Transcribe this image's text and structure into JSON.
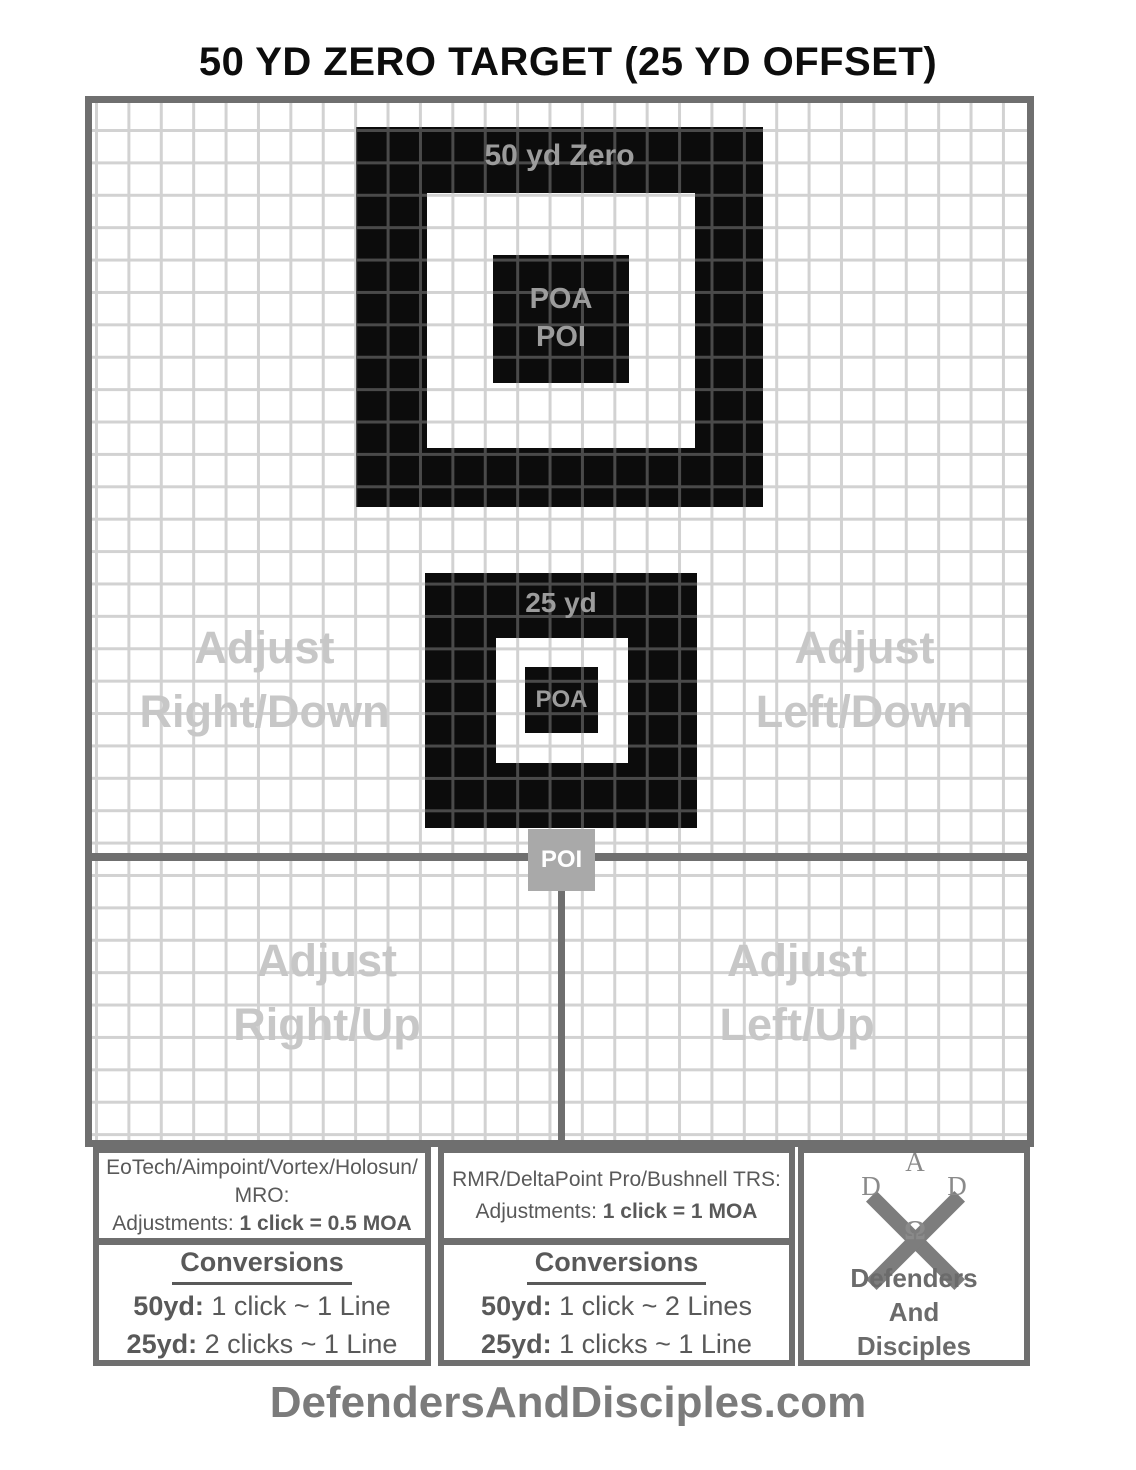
{
  "title": "50 YD ZERO TARGET (25 YD OFFSET)",
  "grid": {
    "target_50": {
      "label": "50 yd Zero",
      "line1": "POA",
      "line2": "POI"
    },
    "target_25": {
      "label": "25 yd",
      "poa": "POA"
    },
    "poi_marker": "POI",
    "watermarks": {
      "upper_left": {
        "line1": "Adjust",
        "line2": "Right/Down"
      },
      "upper_right": {
        "line1": "Adjust",
        "line2": "Left/Down"
      },
      "lower_left": {
        "line1": "Adjust",
        "line2": "Right/Up"
      },
      "lower_right": {
        "line1": "Adjust",
        "line2": "Left/Up"
      }
    }
  },
  "panels": {
    "left": {
      "optics_line1": "EoTech/Aimpoint/Vortex/Holosun/",
      "optics_line2": "MRO:",
      "adjustments_label": "Adjustments: ",
      "adjustments_value": "1 click = 0.5 MOA",
      "conversions_title": "Conversions",
      "conv_rows": [
        {
          "label": "50yd:",
          "value": " 1 click ~ 1 Line"
        },
        {
          "label": "25yd:",
          "value": " 2 clicks ~ 1 Line"
        }
      ]
    },
    "middle": {
      "optics_line1": "RMR/DeltaPoint Pro/Bushnell TRS:",
      "adjustments_label": "Adjustments: ",
      "adjustments_value": "1 click = 1 MOA",
      "conversions_title": "Conversions",
      "conv_rows": [
        {
          "label": "50yd:",
          "value": " 1 click ~ 2 Lines"
        },
        {
          "label": "25yd:",
          "value": " 1 clicks ~ 1 Line"
        }
      ]
    },
    "logo": {
      "letter_top": "A",
      "letter_left": "D",
      "letter_right": "D",
      "letter_bottom": "Ω",
      "name_line1": "Defenders",
      "name_line2": "And",
      "name_line3": "Disciples"
    }
  },
  "footer": "DefendersAndDisciples.com",
  "colors": {
    "target_black": "#0c0c0c",
    "border_gray": "#6f6f6f",
    "grid_line_light": "#d2d2d2",
    "grid_line_dark": "#4a4a4a",
    "watermark_gray": "#c7c7c7",
    "poi_box_gray": "#a9a9a9",
    "target_label_gray": "#9c9c9c",
    "panel_text_gray": "#595959",
    "footer_gray": "#7b7b7b"
  }
}
